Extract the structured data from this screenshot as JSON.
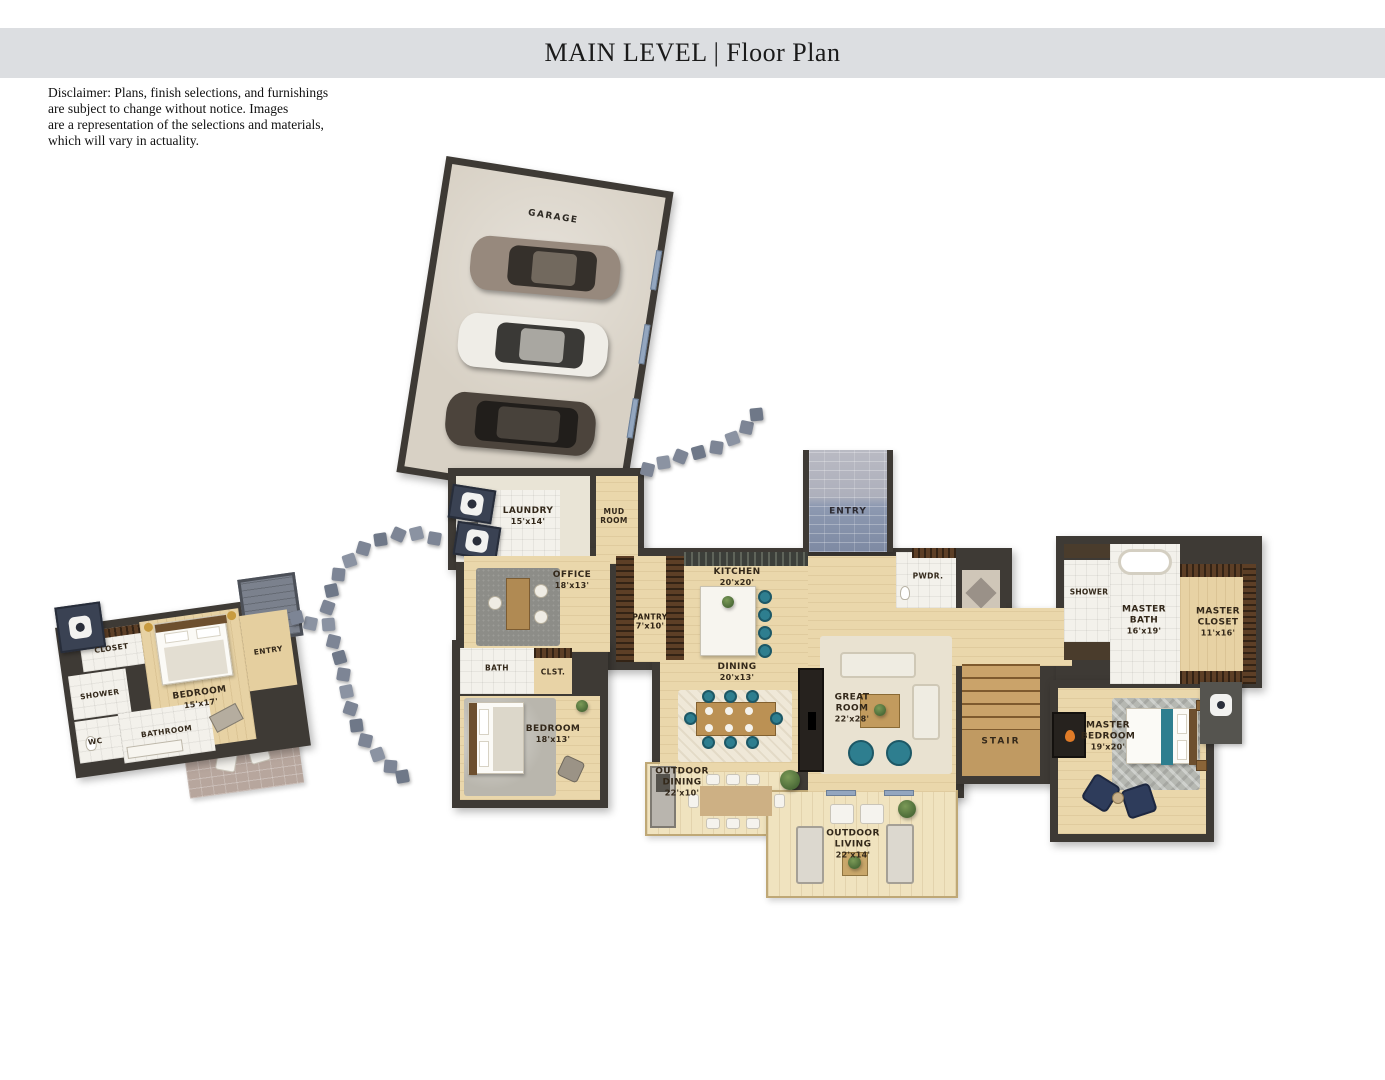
{
  "header": {
    "title": "MAIN LEVEL | Floor Plan"
  },
  "disclaimer": {
    "lines": [
      "Disclaimer: Plans, finish selections, and furnishings",
      "are subject to change without notice. Images",
      "are a representation of the selections and materials,",
      "which will vary in actuality."
    ]
  },
  "rooms": {
    "garage": {
      "label": "GARAGE",
      "dims": ""
    },
    "laundry": {
      "label": "LAUNDRY",
      "dims": "15'x14'"
    },
    "mud_room": {
      "label": "MUD ROOM",
      "dims": ""
    },
    "office": {
      "label": "OFFICE",
      "dims": "18'x13'"
    },
    "pantry": {
      "label": "PANTRY",
      "dims": "7'x10'"
    },
    "kitchen": {
      "label": "KITCHEN",
      "dims": "20'x20'"
    },
    "dining": {
      "label": "DINING",
      "dims": "20'x13'"
    },
    "entry": {
      "label": "ENTRY",
      "dims": ""
    },
    "powder": {
      "label": "PWDR.",
      "dims": ""
    },
    "bath": {
      "label": "BATH",
      "dims": ""
    },
    "closet_hall": {
      "label": "CLST.",
      "dims": ""
    },
    "bedroom": {
      "label": "BEDROOM",
      "dims": "18'x13'"
    },
    "great_room": {
      "label": "GREAT ROOM",
      "dims": "22'x28'"
    },
    "stair": {
      "label": "STAIR",
      "dims": ""
    },
    "master_shower": {
      "label": "SHOWER",
      "dims": ""
    },
    "master_bath": {
      "label": "MASTER BATH",
      "dims": "16'x19'"
    },
    "master_closet": {
      "label": "MASTER CLOSET",
      "dims": "11'x16'"
    },
    "master_bedroom": {
      "label": "MASTER BEDROOM",
      "dims": "19'x20'"
    },
    "outdoor_dining": {
      "label": "OUTDOOR DINING",
      "dims": "22'x10'"
    },
    "outdoor_living": {
      "label": "OUTDOOR LIVING",
      "dims": "22'x14'"
    },
    "guest_closet": {
      "label": "CLOSET",
      "dims": ""
    },
    "guest_shower": {
      "label": "SHOWER",
      "dims": ""
    },
    "guest_wc": {
      "label": "WC",
      "dims": ""
    },
    "guest_bathroom": {
      "label": "BATHROOM",
      "dims": ""
    },
    "guest_bedroom": {
      "label": "BEDROOM",
      "dims": "15'x17'"
    },
    "guest_entry": {
      "label": "ENTRY",
      "dims": ""
    }
  },
  "colors": {
    "header_bg": "#dcdee1",
    "wall": "#3e3a35",
    "wood_floor": "#ead7ab",
    "deck_floor": "#f0e3bf",
    "tile_floor": "#f3f1eb",
    "entry_brick": "#8d99b1",
    "accent_teal": "#2e7e8f",
    "accent_navy": "#2e3c5b",
    "stepping_stone": "#7d8595",
    "garage_floor": "#d8d1c5"
  }
}
